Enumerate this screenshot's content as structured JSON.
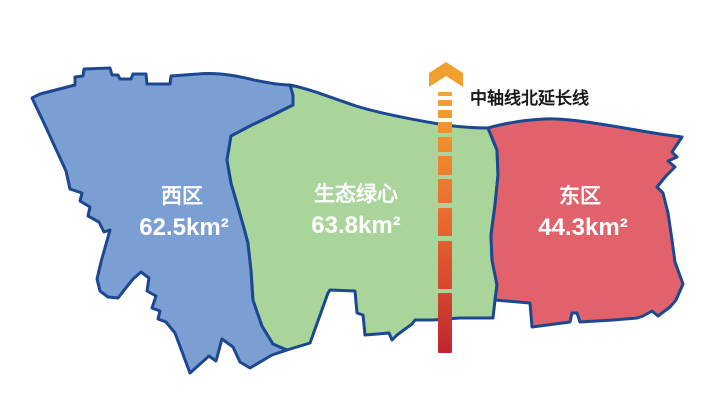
{
  "map": {
    "background": "#FFFFFF",
    "outline_color": "#1C4892",
    "label_text_color": "#FFFFFF"
  },
  "regions": {
    "west": {
      "name": "西区",
      "area": "62.5km²",
      "fill": "#7C9FD3"
    },
    "green_heart": {
      "name": "生态绿心",
      "area": "63.8km²",
      "fill": "#A9D59B"
    },
    "east": {
      "name": "东区",
      "area": "44.3km²",
      "fill": "#E2626C"
    }
  },
  "axis_line": {
    "label": "中轴线北延长线",
    "label_color": "#1A1A1A",
    "arrow_color": "#F0A02F",
    "gradient_top": "#F5A42E",
    "gradient_mid": "#E8692F",
    "gradient_bottom": "#C2252F"
  }
}
